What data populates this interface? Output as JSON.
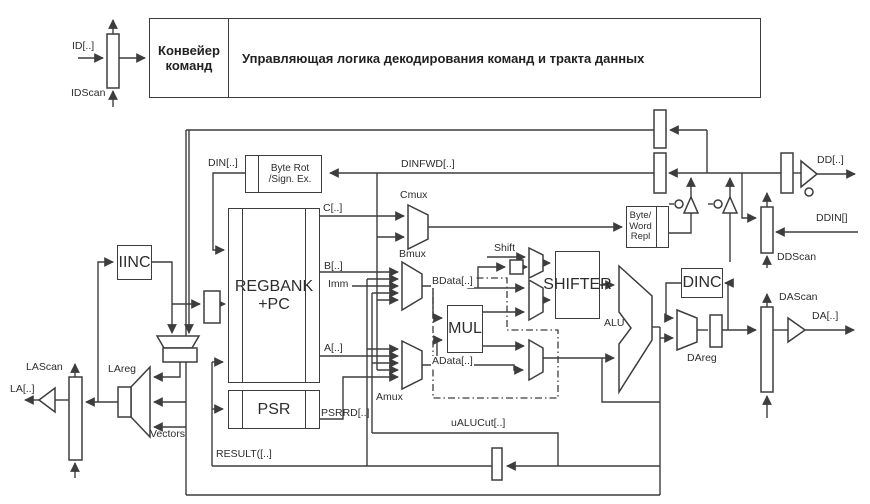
{
  "diagram": {
    "colors": {
      "stroke": "#3d3d3d",
      "text": "#2d2d2d",
      "background": "#ffffff"
    },
    "title_blocks": {
      "pipeline": "Конвейер\nкоманд",
      "control_logic": "Управляющая логика декодирования команд и тракта данных"
    },
    "blocks": {
      "byte_rot": "Byte Rot\n/Sign. Ex.",
      "regbank": "REGBANK\n+PC",
      "psr": "PSR",
      "mul": "MUL",
      "shifter": "SHIFTER",
      "alu": "ALU",
      "byte_word": "Byte/\nWord\nRepl",
      "dinc": "DINC",
      "iinc": "IINC"
    },
    "signals": {
      "id": "ID[..]",
      "idscan": "IDScan",
      "din": "DIN[..]",
      "dinfwd": "DINFWD[..]",
      "c": "C[..]",
      "cmux": "Cmux",
      "b": "B[..]",
      "imm": "Imm",
      "a": "A[..]",
      "bmux": "Bmux",
      "amux": "Amux",
      "bdata": "BData[..]",
      "adata": "AData[..]",
      "shift": "Shift",
      "dareg": "DAreg",
      "dascan": "DAScan",
      "da": "DA[..]",
      "dd": "DD[..]",
      "ddin": "DDIN[]",
      "ddscan": "DDScan",
      "lareg": "LAreg",
      "lascan": "LAScan",
      "la": "LA[..]",
      "vectors": "Vectors",
      "psrrd": "PSRRD[..]",
      "result": "RESULT([..]",
      "ualucut": "uALUCut[..]"
    }
  }
}
